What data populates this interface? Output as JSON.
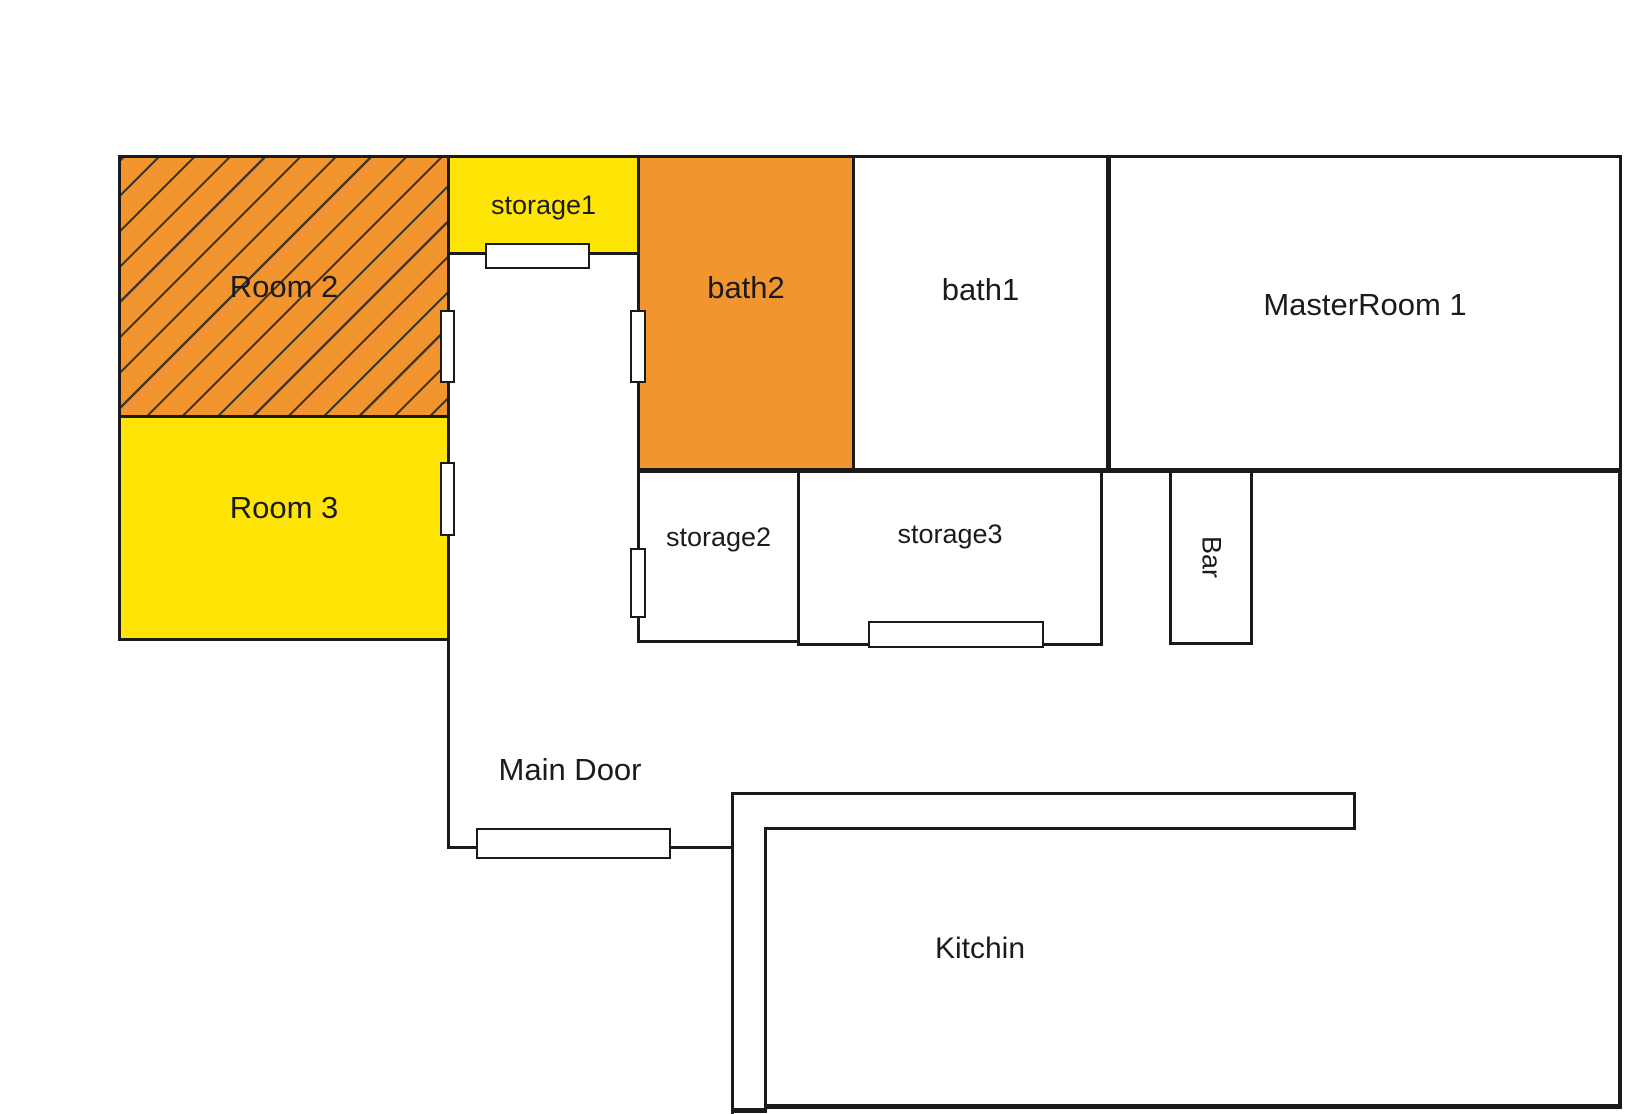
{
  "title": "Apartment floor plan",
  "colors": {
    "orange": "#F2952F",
    "yellow": "#FFE506",
    "wall": "#1A1A1A",
    "hatch_line": "#433524",
    "door_fill": "#FFFFFF",
    "bg": "#FFFFFF",
    "text": "#1B1B1B"
  },
  "rooms": {
    "room2": {
      "label": "Room 2",
      "fill": "orange-hatched"
    },
    "room3": {
      "label": "Room 3",
      "fill": "yellow"
    },
    "storage1": {
      "label": "storage1",
      "fill": "yellow"
    },
    "bath2": {
      "label": "bath2",
      "fill": "orange"
    },
    "bath1": {
      "label": "bath1",
      "fill": "white"
    },
    "master": {
      "label": "MasterRoom 1",
      "fill": "white"
    },
    "storage2": {
      "label": "storage2",
      "fill": "white"
    },
    "storage3": {
      "label": "storage3",
      "fill": "white"
    },
    "bar": {
      "label": "Bar",
      "fill": "white",
      "orientation": "vertical"
    },
    "kitchen": {
      "label": "Kitchin",
      "fill": "white"
    }
  },
  "annotations": {
    "main_door": {
      "label": "Main Door"
    }
  },
  "doors": [
    "storage1-bottom",
    "room2-right",
    "room3-right",
    "bath2-left",
    "storage2-left",
    "storage3-bottom",
    "main-entrance"
  ]
}
